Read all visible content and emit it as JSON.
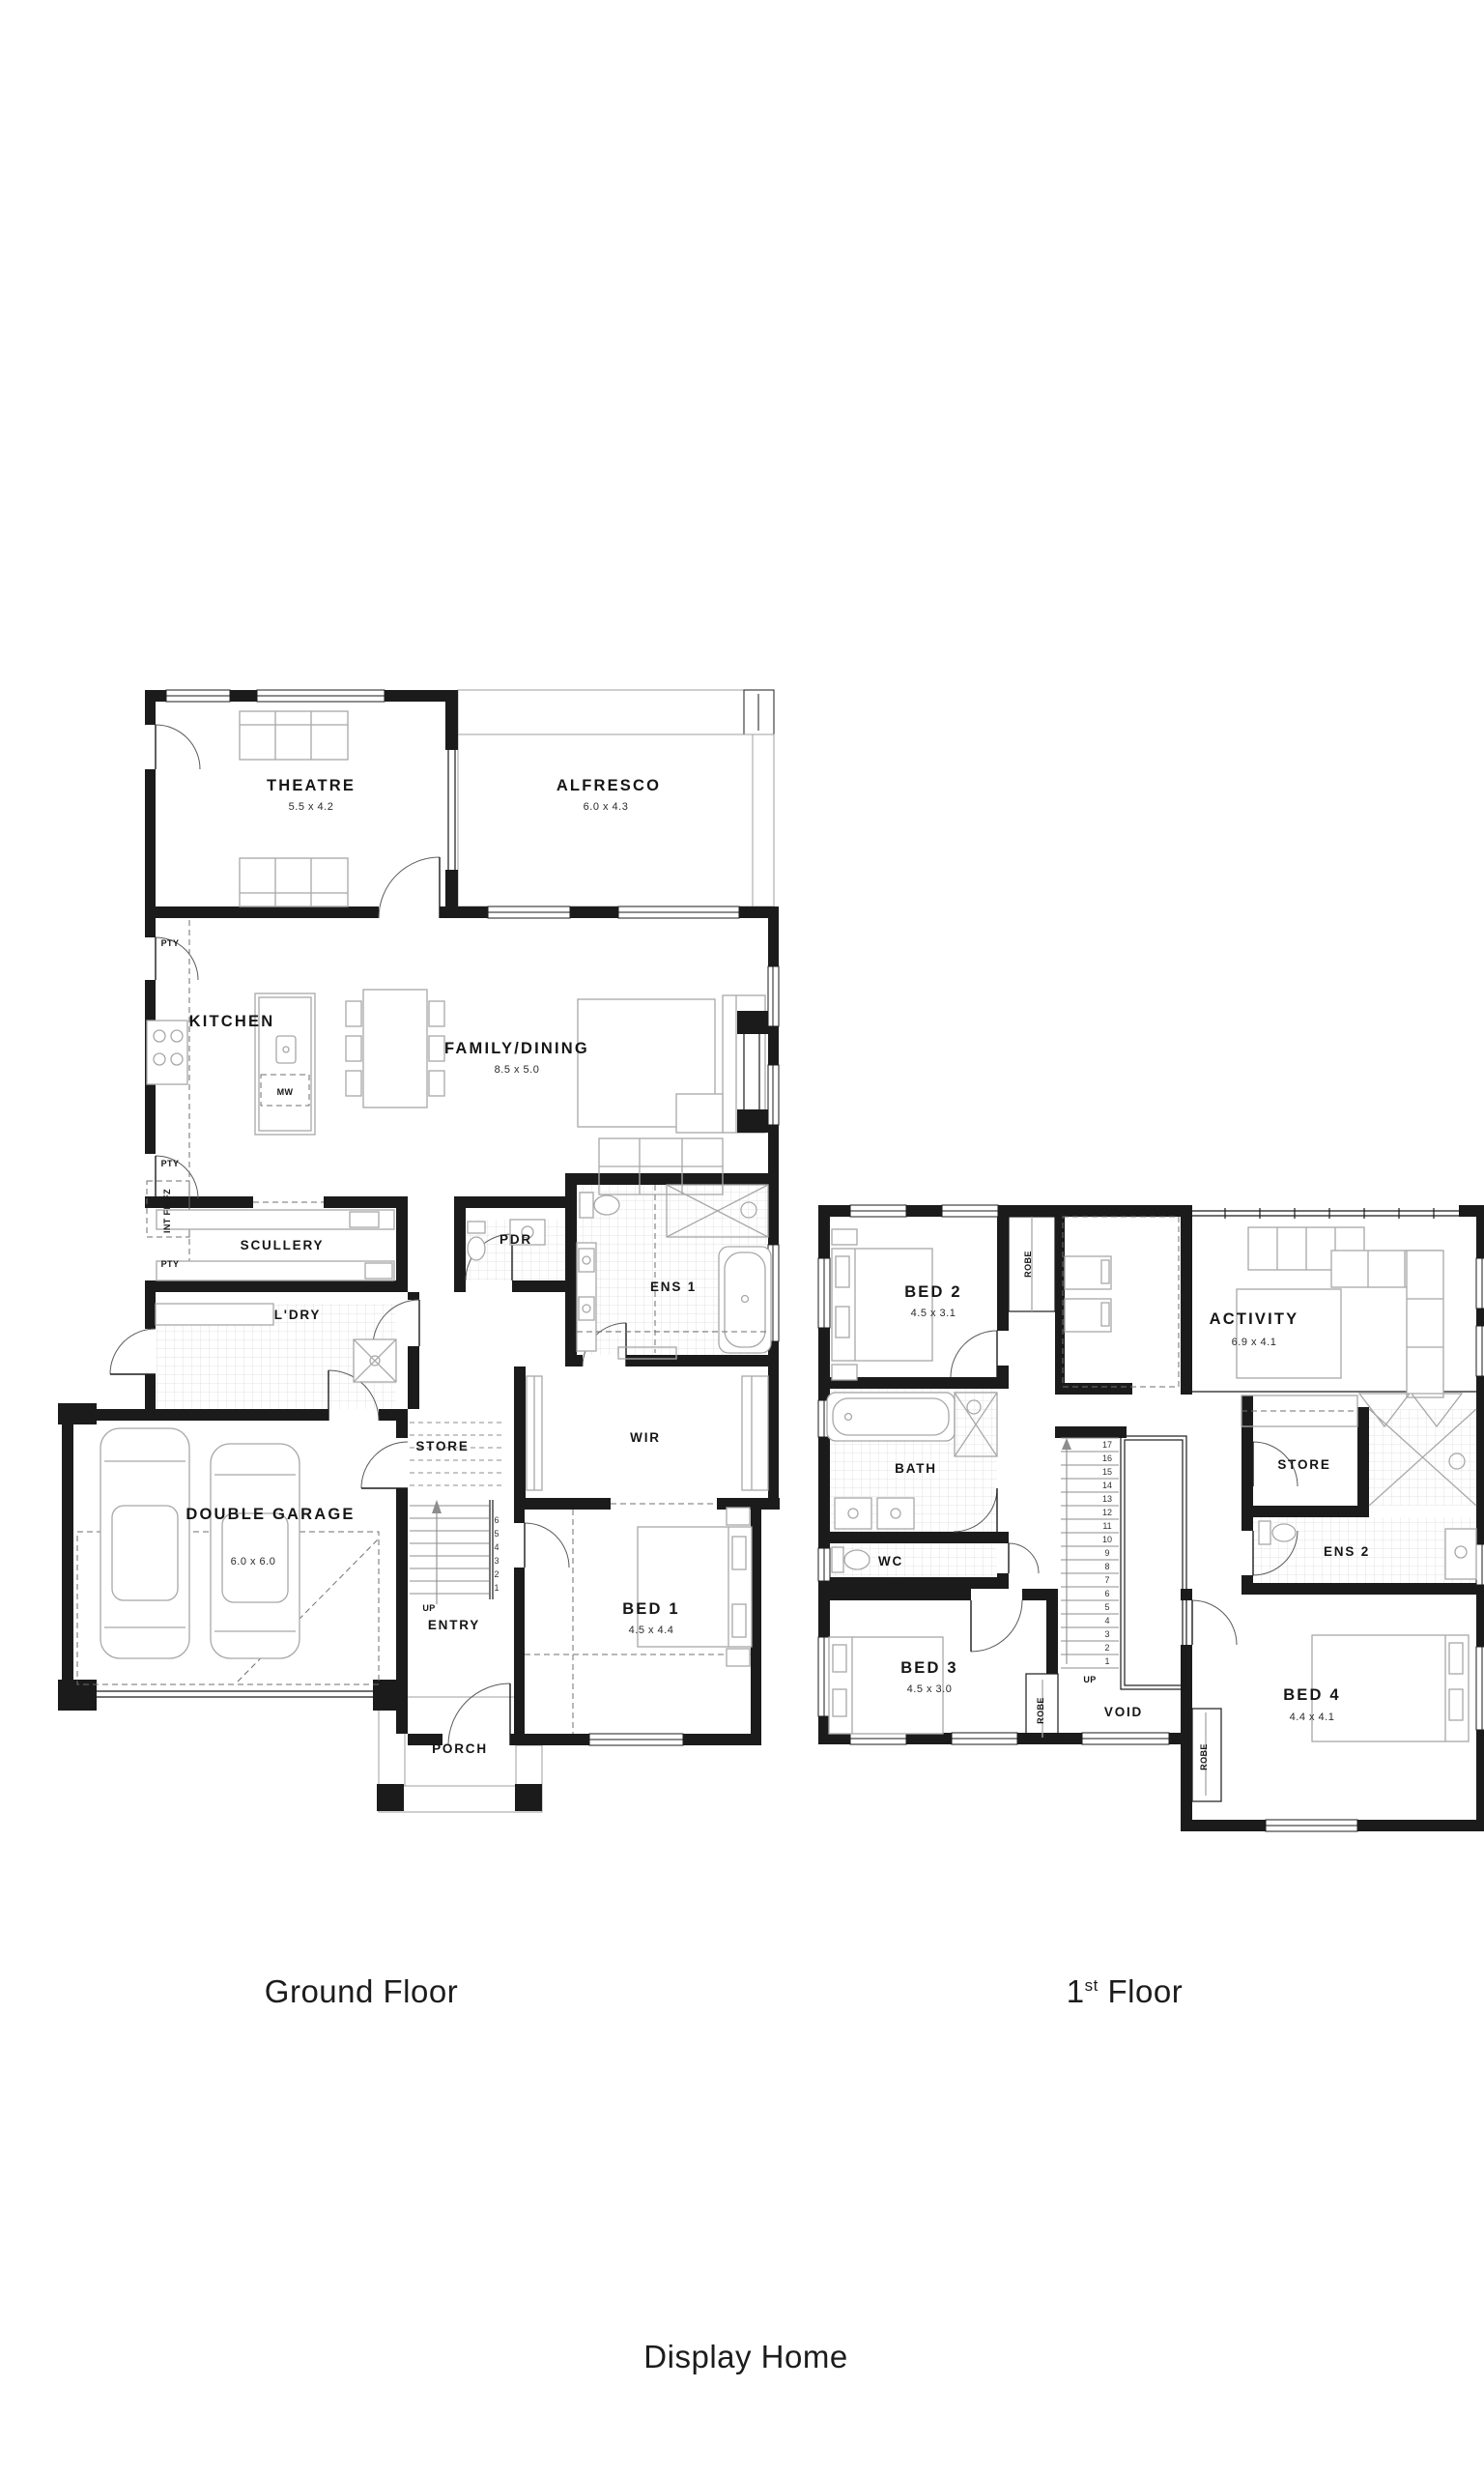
{
  "captions": {
    "ground": "Ground Floor",
    "first_prefix": "1",
    "first_sup": "st",
    "first_suffix": " Floor",
    "footer": "Display Home"
  },
  "ground": {
    "rooms": {
      "theatre": {
        "name": "THEATRE",
        "dims": "5.5 x 4.2"
      },
      "alfresco": {
        "name": "ALFRESCO",
        "dims": "6.0 x 4.3"
      },
      "kitchen": {
        "name": "KITCHEN"
      },
      "family": {
        "name": "FAMILY/DINING",
        "dims": "8.5 x 5.0"
      },
      "scullery": {
        "name": "SCULLERY"
      },
      "pdr": {
        "name": "PDR"
      },
      "ens1": {
        "name": "ENS 1"
      },
      "ldry": {
        "name": "L'DRY"
      },
      "store": {
        "name": "STORE"
      },
      "wir": {
        "name": "WIR"
      },
      "garage": {
        "name": "DOUBLE GARAGE",
        "dims": "6.0 x 6.0"
      },
      "entry": {
        "name": "ENTRY"
      },
      "bed1": {
        "name": "BED 1",
        "dims": "4.5 x 4.4"
      },
      "porch": {
        "name": "PORCH"
      }
    },
    "annotations": {
      "pty": "PTY",
      "fridge": "INT FR/FZ",
      "microwave": "MW",
      "up": "UP"
    },
    "stairs": [
      "6",
      "5",
      "4",
      "3",
      "2",
      "1"
    ]
  },
  "first": {
    "rooms": {
      "bed2": {
        "name": "BED 2",
        "dims": "4.5 x 3.1"
      },
      "activity": {
        "name": "ACTIVITY",
        "dims": "6.9 x 4.1"
      },
      "bath": {
        "name": "BATH"
      },
      "wc": {
        "name": "WC"
      },
      "store": {
        "name": "STORE"
      },
      "ens2": {
        "name": "ENS 2"
      },
      "bed3": {
        "name": "BED 3",
        "dims": "4.5 x 3.0"
      },
      "bed4": {
        "name": "BED 4",
        "dims": "4.4 x 4.1"
      },
      "void": {
        "name": "VOID"
      }
    },
    "annotations": {
      "robe": "ROBE",
      "up": "UP"
    },
    "stairs": [
      "17",
      "16",
      "15",
      "14",
      "13",
      "12",
      "11",
      "10",
      "9",
      "8",
      "7",
      "6",
      "5",
      "4",
      "3",
      "2",
      "1"
    ]
  }
}
